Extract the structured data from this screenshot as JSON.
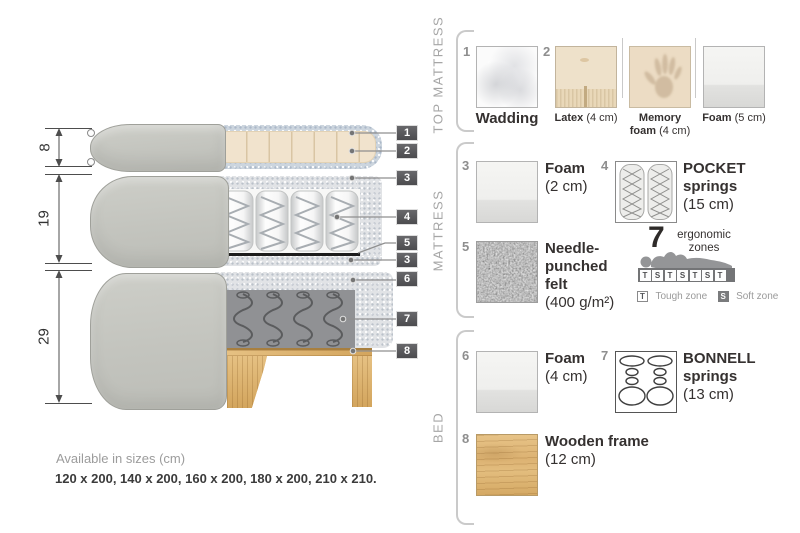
{
  "diagram": {
    "dim_top_mattress_cm": "8",
    "dim_mattress_cm": "19",
    "dim_bed_cm": "29",
    "callouts": [
      {
        "num": "1"
      },
      {
        "num": "2"
      },
      {
        "num": "3"
      },
      {
        "num": "4"
      },
      {
        "num": "5"
      },
      {
        "num": "3"
      },
      {
        "num": "6"
      },
      {
        "num": "7"
      },
      {
        "num": "8"
      }
    ]
  },
  "legend": {
    "top_mattress": {
      "label": "TOP MATTRESS",
      "wadding": {
        "num": "1",
        "name": "Wadding"
      },
      "latex": {
        "num": "2",
        "name": "Latex",
        "size": "(4 cm)"
      },
      "memory_foam": {
        "name_line1": "Memory",
        "name_line2": "foam",
        "size": "(4 cm)"
      },
      "foam": {
        "name": "Foam",
        "size": "(5 cm)"
      }
    },
    "mattress": {
      "label": "MATTRESS",
      "foam": {
        "num": "3",
        "name": "Foam",
        "size": "(2 cm)"
      },
      "pocket": {
        "num": "4",
        "name_line1": "POCKET",
        "name_line2": "springs",
        "size": "(15 cm)"
      },
      "felt": {
        "num": "5",
        "name_line1": "Needle-",
        "name_line2": "punched",
        "name_line3": "felt",
        "size": "(400 g/m²)"
      },
      "ergonomic": {
        "number": "7",
        "label_line1": "ergonomic",
        "label_line2": "zones",
        "zones": [
          "T",
          "S",
          "T",
          "S",
          "T",
          "S",
          "T"
        ],
        "tough_key": "T",
        "tough_label": "Tough zone",
        "soft_key": "S",
        "soft_label": "Soft zone"
      }
    },
    "bed": {
      "label": "BED",
      "foam": {
        "num": "6",
        "name": "Foam",
        "size": "(4 cm)"
      },
      "bonnell": {
        "num": "7",
        "name_line1": "BONNELL",
        "name_line2": "springs",
        "size": "(13 cm)"
      },
      "frame": {
        "num": "8",
        "name": "Wooden frame",
        "size": "(12 cm)"
      }
    }
  },
  "footer": {
    "title": "Available in sizes (cm)",
    "sizes": "120 x 200, 140 x 200, 160 x 200, 180 x 200, 210 x 210."
  },
  "colors": {
    "badge_bg": "#58585a",
    "fabric_gray": "#c7c8c2",
    "latex_cream": "#f1e3cd",
    "wadding_blue_gray": "#ccd5de",
    "foam_speckle": "#e1e3e6",
    "bonnell_gray": "#909194",
    "felt_black": "#1c1c1c",
    "wood": "#dcb06c",
    "text_dark": "#3a3734",
    "text_gray": "#9b9b9b"
  }
}
